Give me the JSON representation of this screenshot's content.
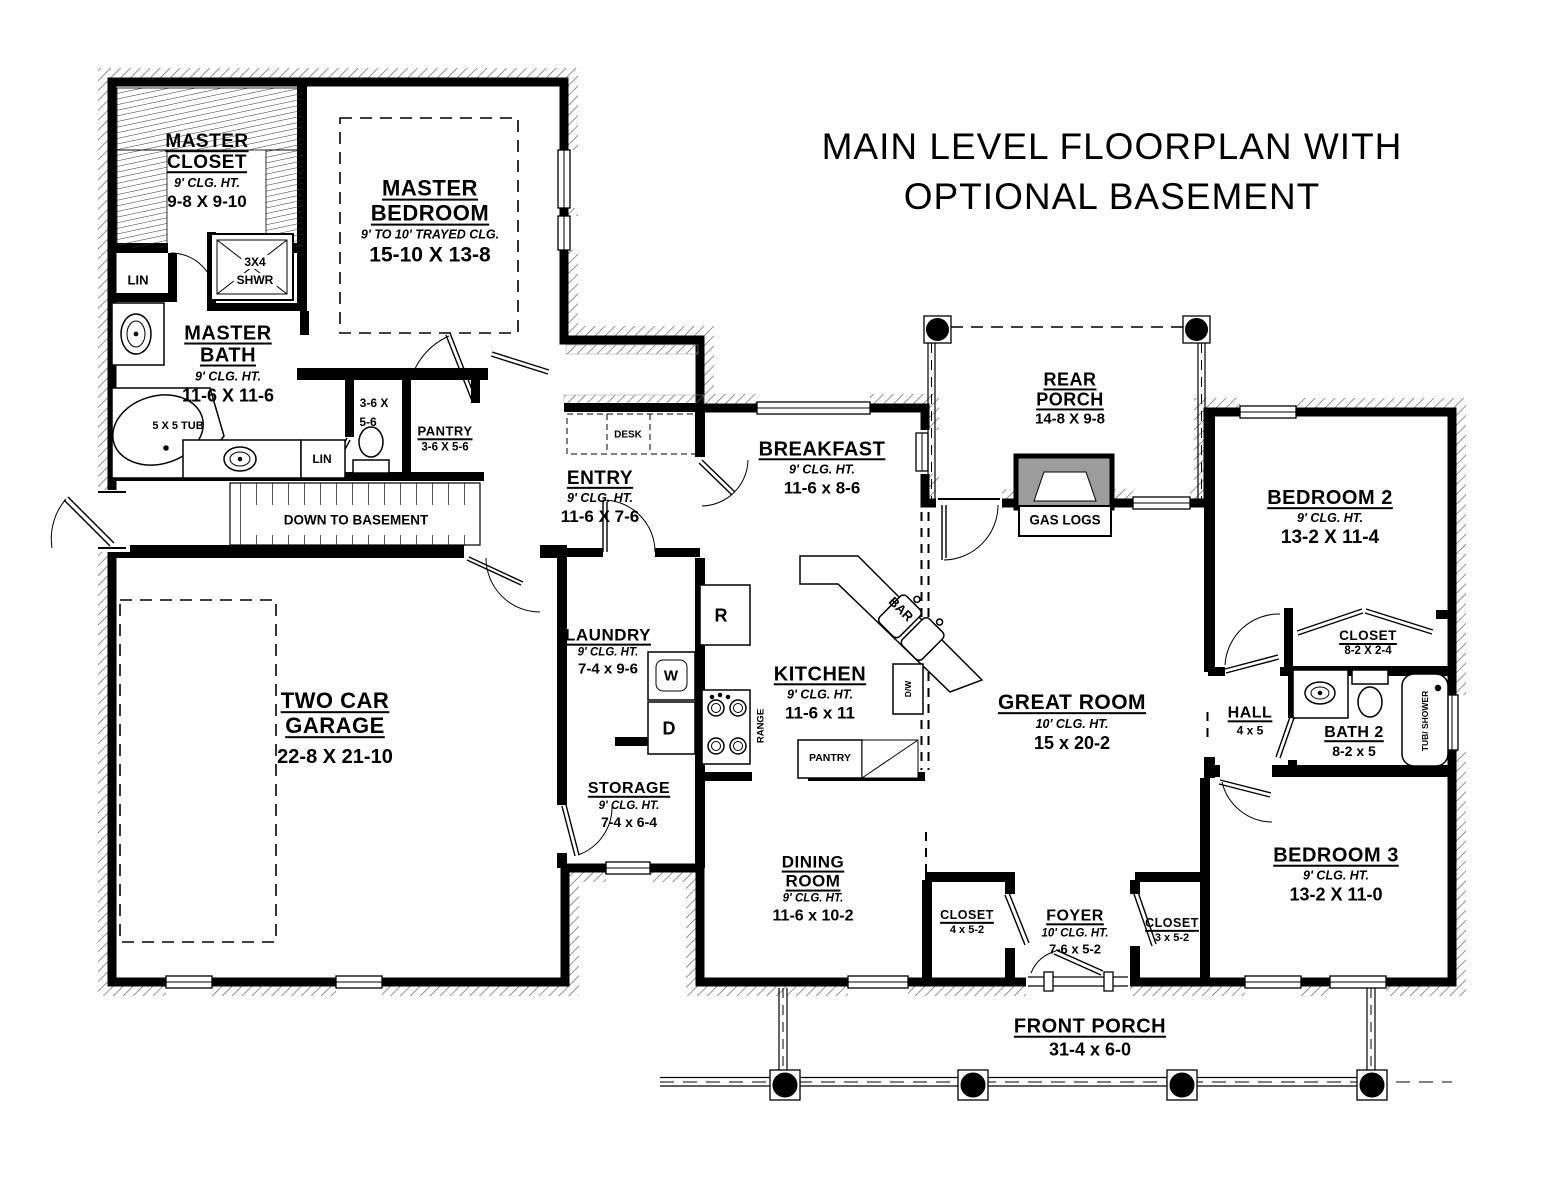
{
  "title": {
    "line1": "MAIN LEVEL FLOORPLAN WITH",
    "line2": "OPTIONAL BASEMENT"
  },
  "rooms": {
    "master_closet": {
      "name1": "MASTER",
      "name2": "CLOSET",
      "ceiling": "9' CLG. HT.",
      "dims": "9-8 X 9-10"
    },
    "master_bedroom": {
      "name1": "MASTER",
      "name2": "BEDROOM",
      "ceiling": "9' TO 10' TRAYED CLG.",
      "dims": "15-10 X 13-8"
    },
    "master_bath": {
      "name1": "MASTER",
      "name2": "BATH",
      "ceiling": "9' CLG. HT.",
      "dims": "11-6 X 11-6"
    },
    "entry": {
      "name1": "ENTRY",
      "ceiling": "9' CLG. HT.",
      "dims": "11-6 X 7-6"
    },
    "breakfast": {
      "name1": "BREAKFAST",
      "ceiling": "9' CLG. HT.",
      "dims": "11-6 x 8-6"
    },
    "laundry": {
      "name1": "LAUNDRY",
      "ceiling": "9' CLG. HT.",
      "dims": "7-4 x 9-6"
    },
    "kitchen": {
      "name1": "KITCHEN",
      "ceiling": "9' CLG. HT.",
      "dims": "11-6 x 11"
    },
    "garage": {
      "name1": "TWO CAR",
      "name2": "GARAGE",
      "dims": "22-8 X 21-10"
    },
    "storage": {
      "name1": "STORAGE",
      "ceiling": "9' CLG. HT.",
      "dims": "7-4 x 6-4"
    },
    "dining": {
      "name1": "DINING",
      "name2": "ROOM",
      "ceiling": "9' CLG. HT.",
      "dims": "11-6 x 10-2"
    },
    "rear_porch": {
      "name1": "REAR",
      "name2": "PORCH",
      "dims": "14-8 X 9-8"
    },
    "great_room": {
      "name1": "GREAT ROOM",
      "ceiling": "10' CLG. HT.",
      "dims": "15 x 20-2"
    },
    "bedroom2": {
      "name1": "BEDROOM 2",
      "ceiling": "9' CLG. HT.",
      "dims": "13-2 X 11-4"
    },
    "bedroom2_closet": {
      "name1": "CLOSET",
      "dims": "8-2 X 2-4"
    },
    "hall": {
      "name1": "HALL",
      "dims": "4 x 5"
    },
    "bath2": {
      "name1": "BATH 2",
      "dims": "8-2 x 5"
    },
    "bedroom3": {
      "name1": "BEDROOM 3",
      "ceiling": "9' CLG. HT.",
      "dims": "13-2 X 11-0"
    },
    "foyer": {
      "name1": "FOYER",
      "ceiling": "10' CLG. HT.",
      "dims": "7-6 x 5-2"
    },
    "foyer_closet_left": {
      "name1": "CLOSET",
      "dims": "4 x 5-2"
    },
    "foyer_closet_right": {
      "name1": "CLOSET",
      "dims": "3 x 5-2"
    },
    "front_porch": {
      "name1": "FRONT PORCH",
      "dims": "31-4 x 6-0"
    },
    "pantry1": {
      "name1": "PANTRY",
      "dims": "3-6 X 5-6"
    }
  },
  "fixtures": {
    "lin1": "LIN",
    "lin2": "LIN",
    "shower_line1": "3X4",
    "shower_line2": "SHWR",
    "tub": "5 X 5 TUB",
    "wc_dims_line1": "3-6 X",
    "wc_dims_line2": "5-6",
    "stairs": "DOWN TO BASEMENT",
    "desk": "DESK",
    "fridge": "R",
    "washer": "W",
    "dryer": "D",
    "range": "RANGE",
    "bar": "BAR",
    "dishwasher": "D/W",
    "pantry2": "PANTRY",
    "gas_logs": "GAS LOGS",
    "tub_shower": "TUB/ SHOWER"
  }
}
